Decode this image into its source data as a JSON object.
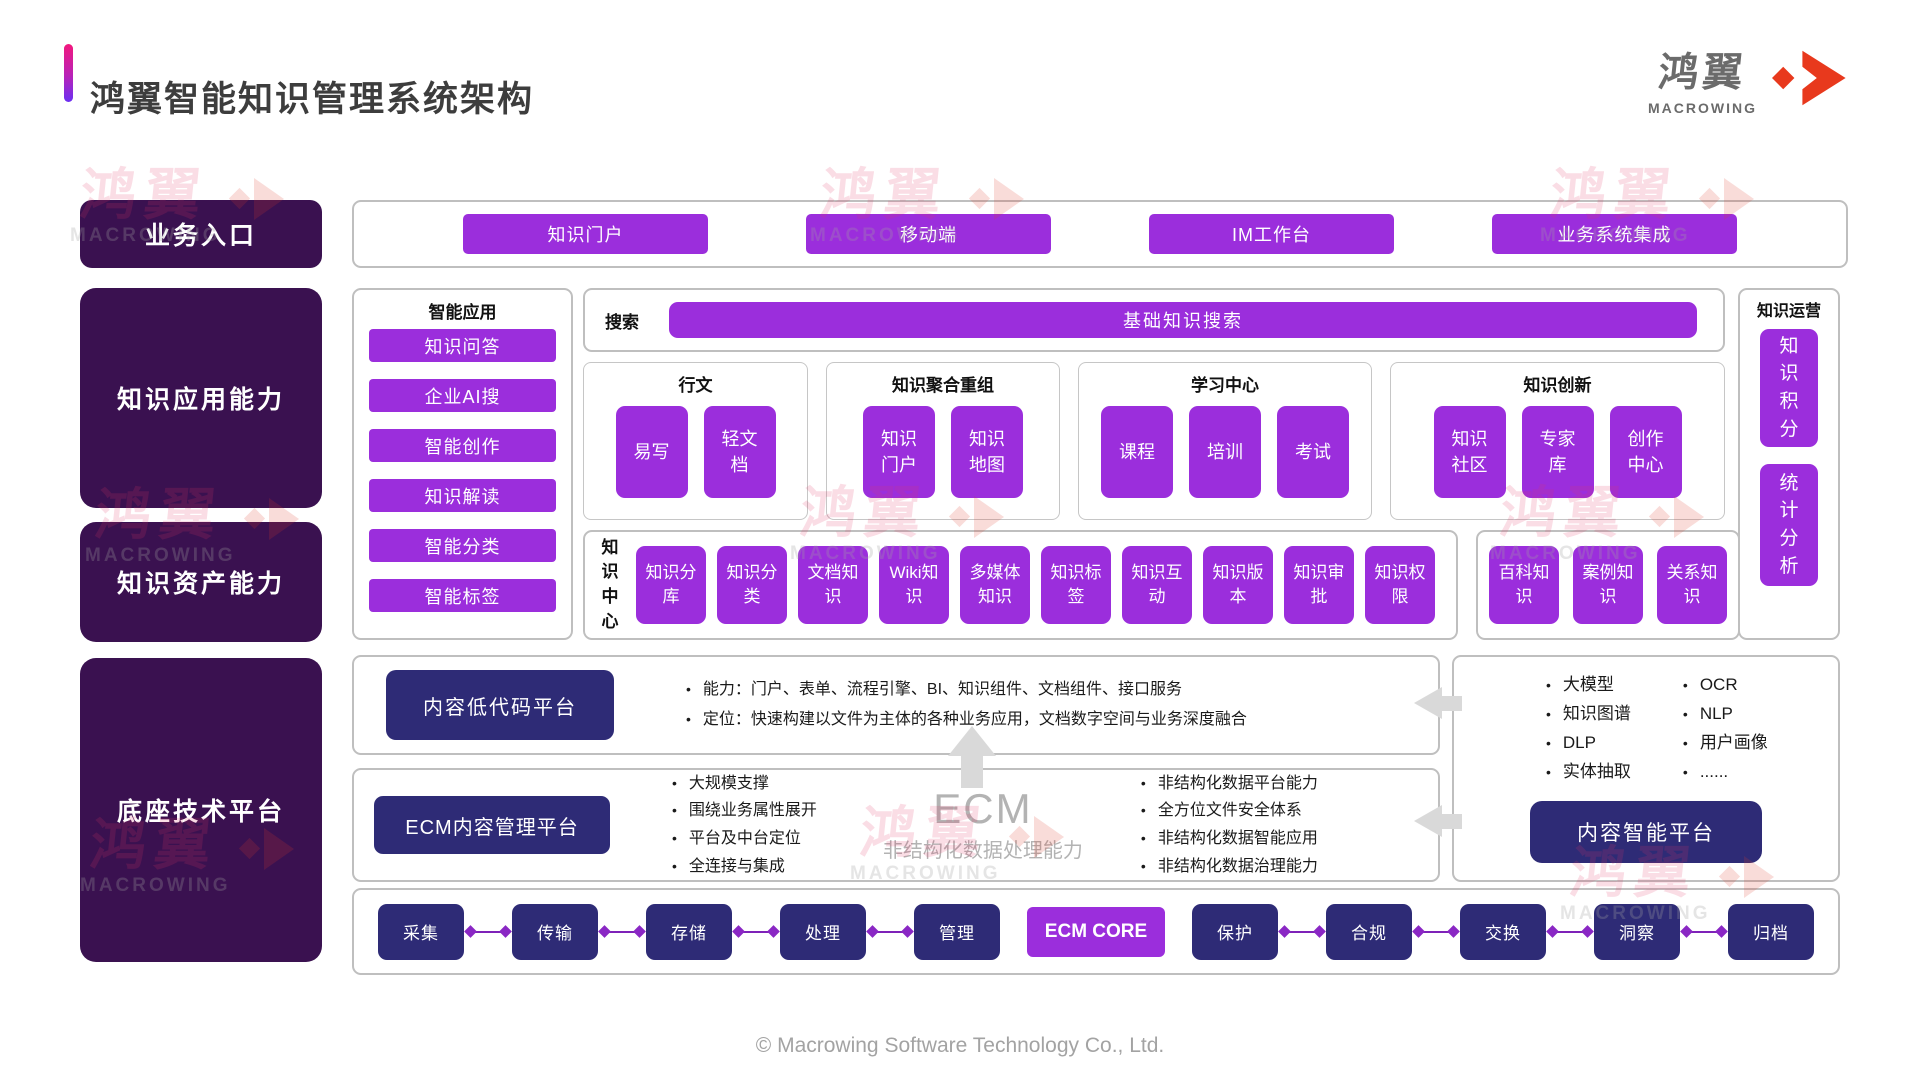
{
  "colors": {
    "accent_purple": "#9B2EDC",
    "deep_navy": "#2E2B76",
    "dark_purple": "#3A1150",
    "logo_red": "#E8391D",
    "gradient_top": "#F2187D",
    "gradient_bottom": "#6B2FF2"
  },
  "header": {
    "title": "鸿翼智能知识管理系统架构",
    "logo_cjk": "鸿翼",
    "logo_latin": "MACROWING",
    "logo_icon": "diamond-arrow-icon"
  },
  "left_rail": [
    "业务入口",
    "知识应用能力",
    "知识资产能力",
    "底座技术平台"
  ],
  "entry_row": [
    "知识门户",
    "移动端",
    "IM工作台",
    "业务系统集成"
  ],
  "smart_apps": {
    "title": "智能应用",
    "items": [
      "知识问答",
      "企业AI搜",
      "智能创作",
      "知识解读",
      "智能分类",
      "智能标签"
    ]
  },
  "search": {
    "label": "搜索",
    "button": "基础知识搜索"
  },
  "groups": [
    {
      "title": "行文",
      "items": [
        "易写",
        "轻文档"
      ]
    },
    {
      "title": "知识聚合重组",
      "items": [
        "知识门户",
        "知识地图"
      ]
    },
    {
      "title": "学习中心",
      "items": [
        "课程",
        "培训",
        "考试"
      ]
    },
    {
      "title": "知识创新",
      "items": [
        "知识社区",
        "专家库",
        "创作中心"
      ]
    }
  ],
  "knowledge_center": {
    "label": "知识中心",
    "items": [
      "知识分库",
      "知识分类",
      "文档知识",
      "Wiki知识",
      "多媒体知识",
      "知识标签",
      "知识互动",
      "知识版本",
      "知识审批",
      "知识权限"
    ],
    "extra_items": [
      "百科知识",
      "案例知识",
      "关系知识"
    ]
  },
  "knowledge_ops": {
    "title": "知识运营",
    "items": [
      "知识积分",
      "统计分析"
    ]
  },
  "lowcode": {
    "button": "内容低代码平台",
    "bullets": [
      "能力：门户、表单、流程引擎、BI、知识组件、文档组件、接口服务",
      "定位：快速构建以文件为主体的各种业务应用，文档数字空间与业务深度融合"
    ]
  },
  "ecm": {
    "button": "ECM内容管理平台",
    "left_bullets": [
      "大规模支撑",
      "围绕业务属性展开",
      "平台及中台定位",
      "全连接与集成"
    ],
    "center_title": "ECM",
    "center_subtitle": "非结构化数据处理能力",
    "right_bullets": [
      "非结构化数据平台能力",
      "全方位文件安全体系",
      "非结构化数据智能应用",
      "非结构化数据治理能力"
    ]
  },
  "intelligence": {
    "bullets_col1": [
      "大模型",
      "知识图谱",
      "DLP",
      "实体抽取"
    ],
    "bullets_col2": [
      "OCR",
      "NLP",
      "用户画像",
      "......"
    ],
    "button": "内容智能平台"
  },
  "pipeline": {
    "left": [
      "采集",
      "传输",
      "存储",
      "处理",
      "管理"
    ],
    "core": "ECM CORE",
    "right": [
      "保护",
      "合规",
      "交换",
      "洞察",
      "归档"
    ]
  },
  "watermark": {
    "cjk": "鸿翼",
    "latin": "MACROWING"
  },
  "footer": "© Macrowing Software Technology Co., Ltd."
}
